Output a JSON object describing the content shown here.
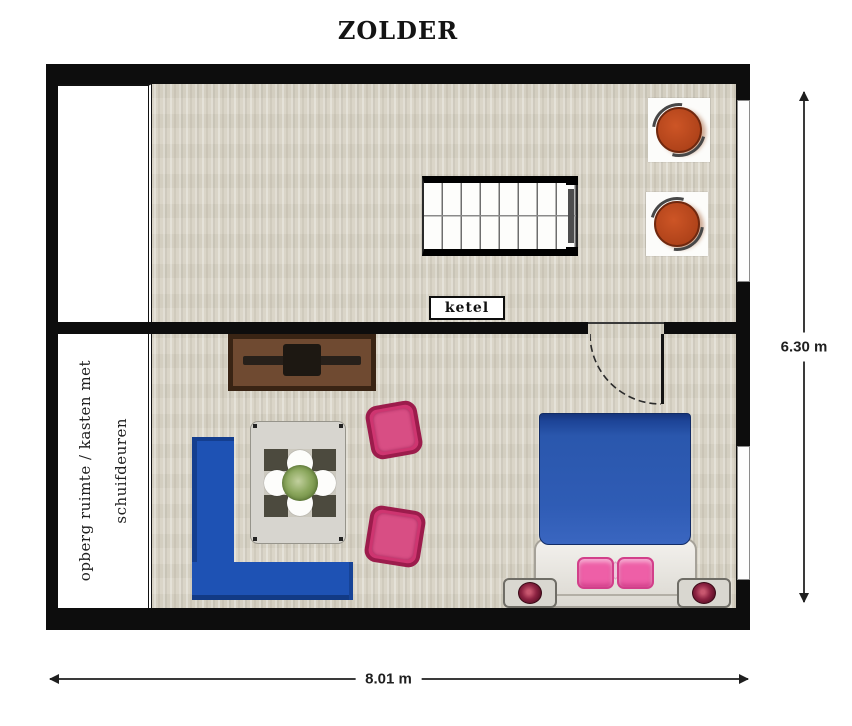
{
  "title": "ZOLDER",
  "plan": {
    "boiler_label": "ketel",
    "storage_label_line1": "opberg ruimte / kasten met",
    "storage_label_line2": "schuifdeuren",
    "dimension_height": "6.30 m",
    "dimension_width": "8.01 m"
  },
  "colors": {
    "wall": "#0d0d0d",
    "floor": "#d8d3c5",
    "sofa_blue": "#1e52b4",
    "bed_blanket_blue": "#2a57ad",
    "armchair_pink": "#ce3570",
    "pillow_pink": "#ee5fa7",
    "lounge_chair_orange": "#b0431a",
    "cabinet_brown": "#6f4a31",
    "dimension_line": "#3a3a3a"
  }
}
